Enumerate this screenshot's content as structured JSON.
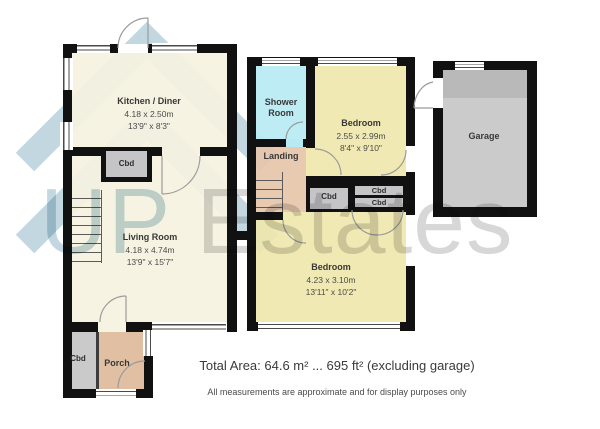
{
  "watermark": {
    "prefix": "UP ",
    "suffix": "Estates"
  },
  "rooms": {
    "kitchen": {
      "name": "Kitchen / Diner",
      "metric": "4.18 x 2.50m",
      "imperial": "13'9\" x 8'3\""
    },
    "living": {
      "name": "Living Room",
      "metric": "4.18 x 4.74m",
      "imperial": "13'9\" x 15'7\""
    },
    "porch": {
      "name": "Porch"
    },
    "shower": {
      "name": "Shower Room"
    },
    "landing": {
      "name": "Landing"
    },
    "bedroom1": {
      "name": "Bedroom",
      "metric": "2.55 x 2.99m",
      "imperial": "8'4\" x 9'10\""
    },
    "bedroom2": {
      "name": "Bedroom",
      "metric": "4.23 x 3.10m",
      "imperial": "13'11\" x 10'2\""
    },
    "garage": {
      "name": "Garage"
    }
  },
  "cupboards": {
    "label": "Cbd"
  },
  "footer": {
    "total_area": "Total Area: 64.6 m² ... 695 ft² (excluding garage)",
    "disclaimer": "All measurements are approximate and for display purposes only"
  },
  "colors": {
    "wall": "#111111",
    "cream": "#f6f2df",
    "yellow": "#efe7ad",
    "cyan": "#b8eaf3",
    "landing": "#e6c6a9",
    "porch": "#ddba9a",
    "cbd": "#c5c5c7",
    "garage": "#cbcbcb",
    "garagedark": "#b9b9b9",
    "logoblue": "#c2d7e0",
    "wmgray": "#d7d7d7"
  }
}
